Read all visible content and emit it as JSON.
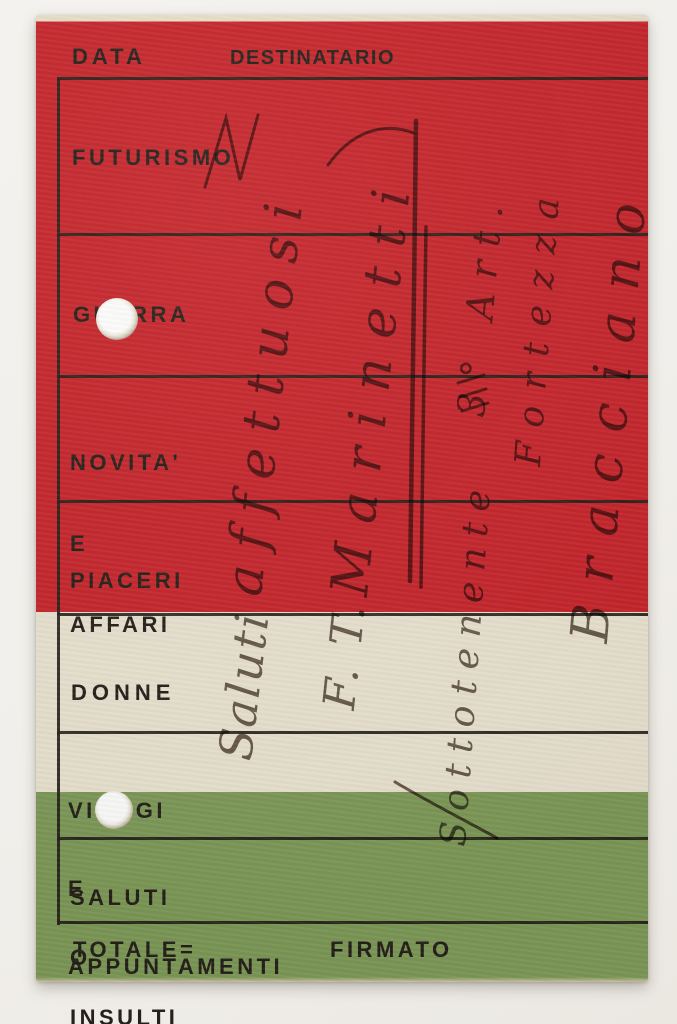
{
  "card": {
    "header": {
      "data_label": "DATA",
      "destinatario_label": "DESTINATARIO"
    },
    "rows": [
      {
        "id": "futurismo",
        "lines": [
          "FUTURISMO"
        ]
      },
      {
        "id": "guerra",
        "lines": [
          "GUERRA"
        ]
      },
      {
        "id": "novita-e-affari",
        "lines": [
          "NOVITA'",
          "E",
          "AFFARI"
        ]
      },
      {
        "id": "piaceri",
        "lines": [
          "PIACERI"
        ]
      },
      {
        "id": "donne",
        "lines": [
          "DONNE"
        ]
      },
      {
        "id": "viaggi-e-appuntamenti",
        "lines": [
          "VIAGGI",
          "E",
          "APPUNTAMENTI"
        ]
      },
      {
        "id": "saluti-o-insulti",
        "lines": [
          "SALUTI",
          "O",
          "INSULTI"
        ]
      }
    ],
    "footer": {
      "totale_label": "TOTALE=",
      "firmato_label": "FIRMATO"
    },
    "handwriting": {
      "saluti": "Saluti",
      "affettuosi": "affettuosi",
      "f_t": "F. T.",
      "marinetti": "Marinetti",
      "sottotenente": "Sottotenente",
      "art": "3° Art.",
      "fortezza": "Fortezza",
      "bracciano": "Bracciano"
    },
    "colors": {
      "red": "#c5252b",
      "cream": "#e9e2d0",
      "green": "#7e9958",
      "line_ink": "#25201a",
      "pencil": "#4f4138",
      "paper": "#f1efeb"
    }
  }
}
